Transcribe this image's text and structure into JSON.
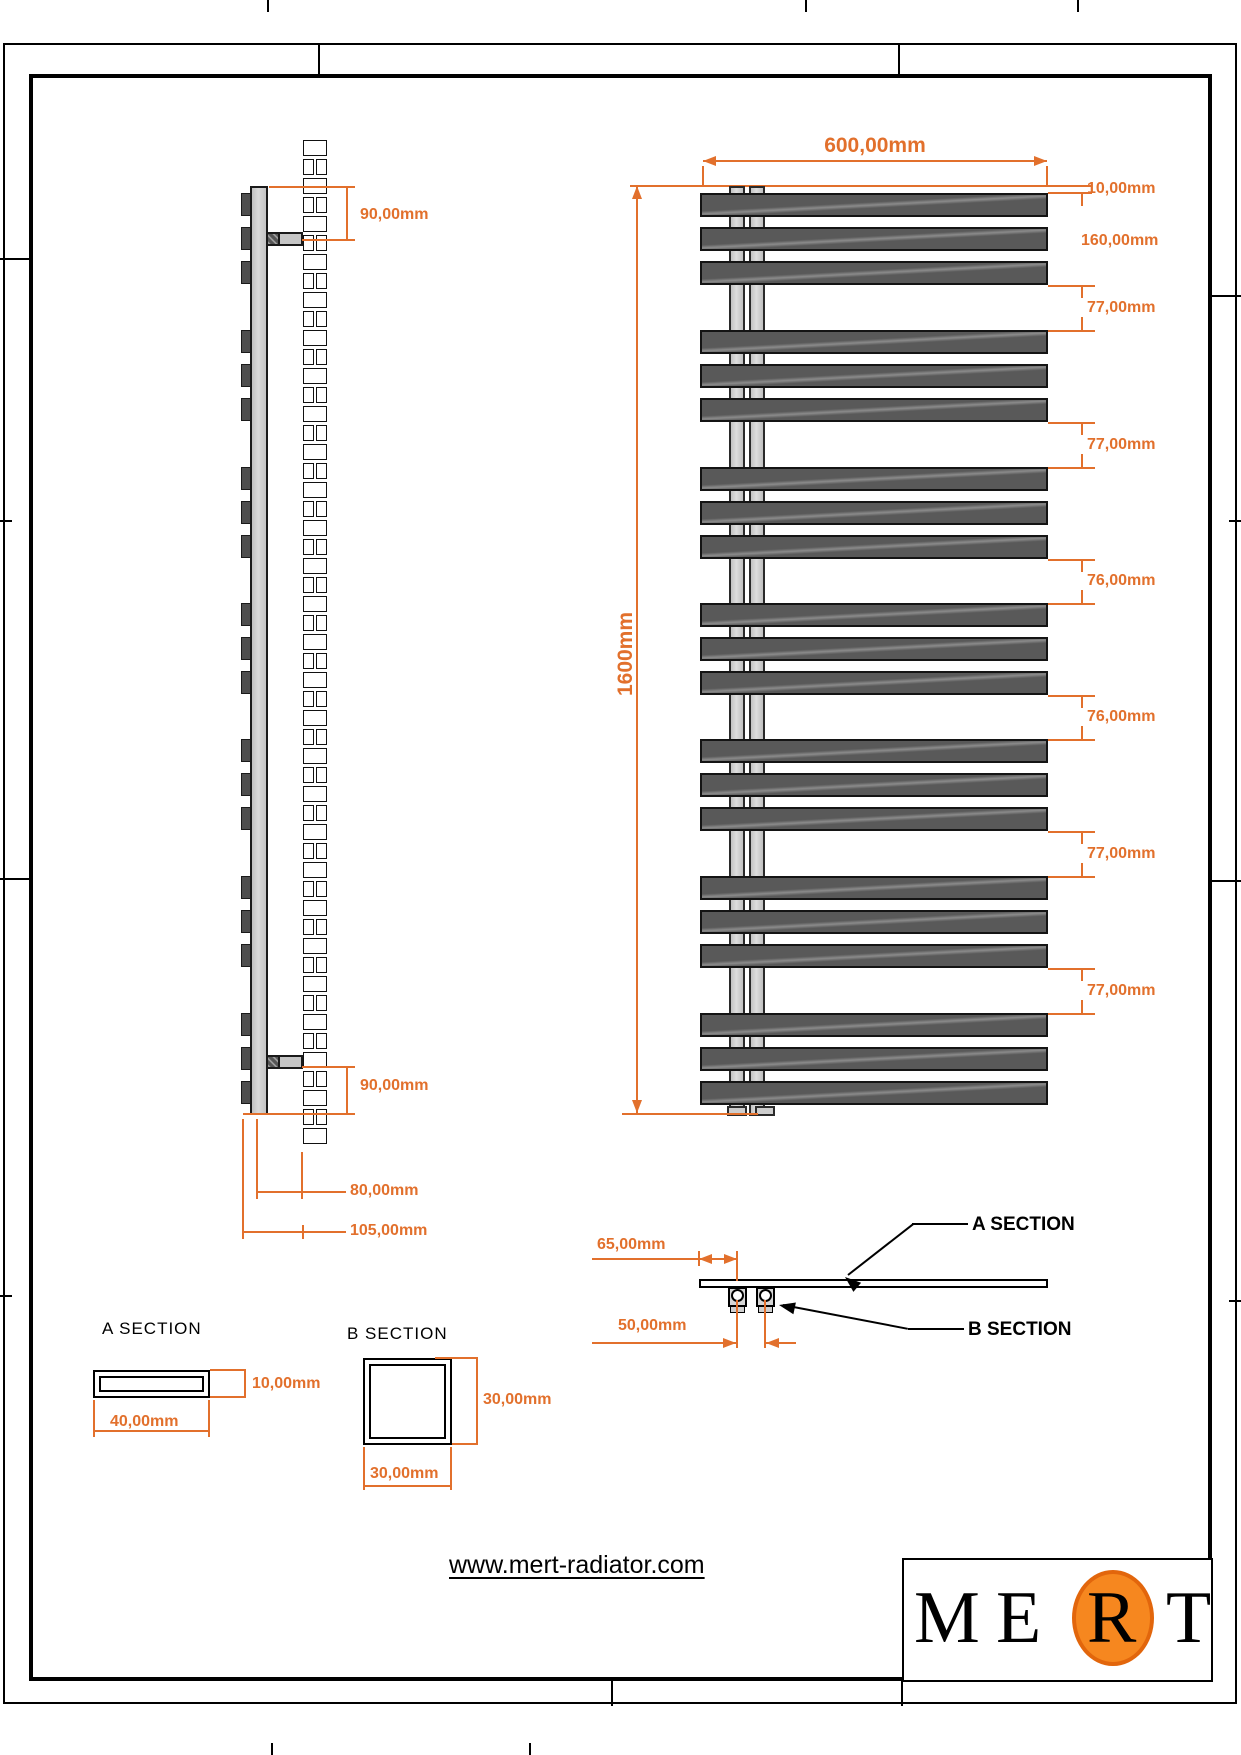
{
  "colors": {
    "dimension": "#e2702c",
    "logo_orange": "#f6871f",
    "logo_orange_border": "#e2660c",
    "bar_fill": "#595959"
  },
  "front_view": {
    "width_dim": "600,00mm",
    "height_dim": "1600mm",
    "top_offset_dim": "10,00mm",
    "group_height_dim": "160,00mm",
    "gap_dims": [
      "77,00mm",
      "77,00mm",
      "76,00mm",
      "76,00mm",
      "77,00mm",
      "77,00mm"
    ],
    "bars_per_group": 3,
    "group_count": 7
  },
  "side_view": {
    "top_bracket_dim": "90,00mm",
    "bottom_bracket_dim": "90,00mm",
    "wall_offset_dim": "80,00mm",
    "total_depth_dim": "105,00mm",
    "brick_courses": 53
  },
  "plan_view": {
    "end_offset_dim": "65,00mm",
    "tube_spacing_dim": "50,00mm",
    "section_a_callout": "A SECTION",
    "section_b_callout": "B SECTION"
  },
  "section_details": {
    "a": {
      "title": "A SECTION",
      "thickness_dim": "10,00mm",
      "width_dim": "40,00mm"
    },
    "b": {
      "title": "B SECTION",
      "height_dim": "30,00mm",
      "width_dim": "30,00mm"
    }
  },
  "footer": {
    "website": "www.mert-radiator.com",
    "brand_letters": [
      "M",
      "E",
      "R",
      "T"
    ]
  }
}
